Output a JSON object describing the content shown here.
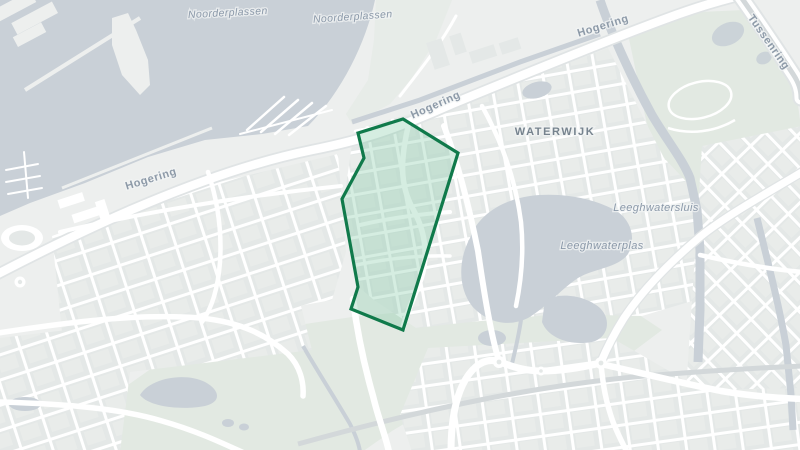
{
  "map": {
    "labels": {
      "noorderplassen_1": "Noorderplassen",
      "noorderplassen_2": "Noorderplassen",
      "hogering_1": "Hogering",
      "hogering_2": "Hogering",
      "hogering_3": "Hogering",
      "tussenring": "Tussenring",
      "waterwijk": "WATERWIJK",
      "leeghwatersluis": "Leeghwatersluis",
      "leeghwaterplas": "Leeghwaterplas"
    },
    "selection": {
      "points": "358,133 403,119 458,153 403,330 351,309 358,287 342,199 364,158"
    },
    "colors": {
      "land": "#edefee",
      "park": "#e2e9e2",
      "water": "#c9d0d7",
      "building": "#e4e8e7",
      "road": "#ffffff",
      "road_casing": "#e0e4e5",
      "railway": "#d3d8da",
      "selection_fill": "rgba(126,200,163,0.33)",
      "selection_stroke": "#107a4b",
      "label_water": "#8b99a9",
      "label_road": "#8d9aa8",
      "label_district": "#76838e"
    }
  }
}
